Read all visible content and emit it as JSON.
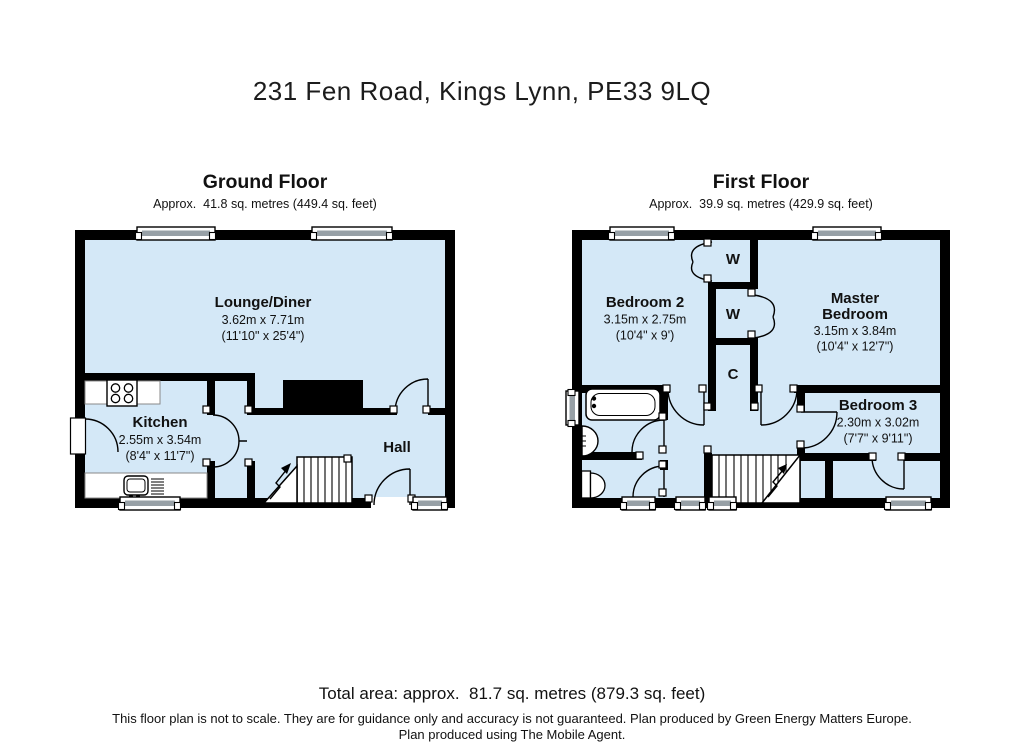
{
  "page": {
    "title": "231 Fen Road, Kings Lynn, PE33 9LQ",
    "total_area": "Total area: approx.  81.7 sq. metres (879.3 sq. feet)",
    "disclaimer_line1": "This floor plan is not to scale. They are for guidance only and accuracy is not guaranteed. Plan produced by Green Energy Matters Europe.",
    "disclaimer_line2": "Plan produced using The Mobile Agent."
  },
  "colors": {
    "room_fill": "#d4e8f7",
    "wall": "#000000",
    "window_gray": "#97a0a6"
  },
  "ground_floor": {
    "title": "Ground Floor",
    "area": "Approx.  41.8 sq. metres (449.4 sq. feet)",
    "rooms": {
      "lounge_diner": {
        "name": "Lounge/Diner",
        "metric": "3.62m x 7.71m",
        "imperial": "(11'10\" x 25'4\")"
      },
      "kitchen": {
        "name": "Kitchen",
        "metric": "2.55m x 3.54m",
        "imperial": "(8'4\" x 11'7\")"
      },
      "hall": {
        "name": "Hall"
      }
    }
  },
  "first_floor": {
    "title": "First Floor",
    "area": "Approx.  39.9 sq. metres (429.9 sq. feet)",
    "rooms": {
      "bedroom2": {
        "name": "Bedroom 2",
        "metric": "3.15m x 2.75m",
        "imperial": "(10'4\" x 9')"
      },
      "master_bedroom": {
        "name_line1": "Master",
        "name_line2": "Bedroom",
        "metric": "3.15m x 3.84m",
        "imperial": "(10'4\" x 12'7\")"
      },
      "bedroom3": {
        "name": "Bedroom 3",
        "metric": "2.30m x 3.02m",
        "imperial": "(7'7\" x 9'11\")"
      },
      "wardrobe1": {
        "label": "W"
      },
      "wardrobe2": {
        "label": "W"
      },
      "cupboard": {
        "label": "C"
      }
    }
  }
}
